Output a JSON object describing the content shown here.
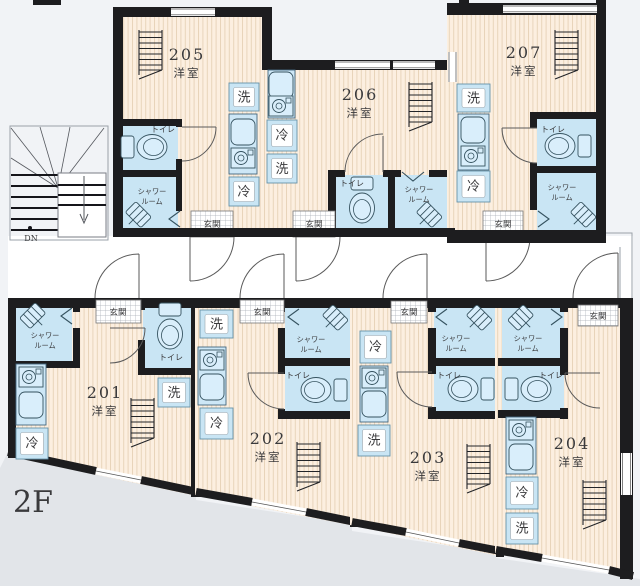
{
  "floor_label": "2F",
  "stairs": {
    "down_label": "DN"
  },
  "labels": {
    "room_type": "洋室",
    "toilet": "トイレ",
    "shower_line1": "シャワー",
    "shower_line2": "ルーム",
    "entrance": "玄関",
    "washer": "洗",
    "fridge": "冷"
  },
  "units": [
    {
      "number": "201"
    },
    {
      "number": "202"
    },
    {
      "number": "203"
    },
    {
      "number": "204"
    },
    {
      "number": "205"
    },
    {
      "number": "206"
    },
    {
      "number": "207"
    }
  ],
  "colors": {
    "wall": "#1d1d1f",
    "floor": "#fcefe0",
    "wet_area": "#c9e5f4",
    "background": "#f1f3f6",
    "outside_shade": "#e2e5e9"
  }
}
